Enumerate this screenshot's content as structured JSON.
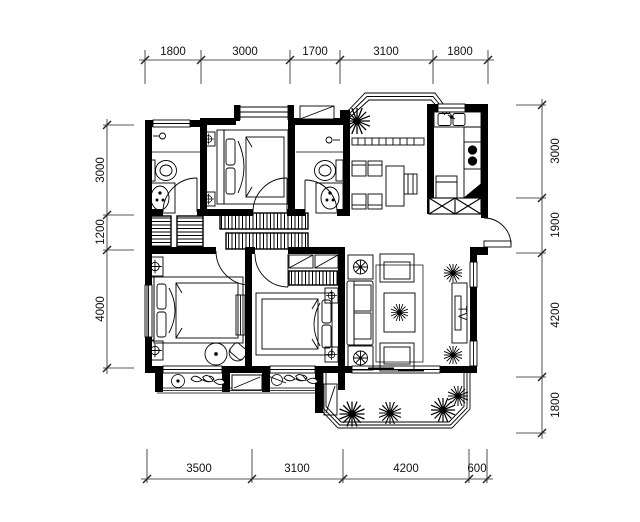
{
  "drawing": {
    "type": "residential-floor-plan",
    "background_color": "#ffffff",
    "line_color": "#000000",
    "tv_label": "TV"
  },
  "dimensions": {
    "top": [
      "1800",
      "3000",
      "1700",
      "3100",
      "1800"
    ],
    "left": [
      "3000",
      "1200",
      "4000"
    ],
    "right": [
      "3000",
      "1900",
      "4200",
      "1800"
    ],
    "bottom": [
      "3500",
      "3100",
      "4200",
      "600"
    ]
  },
  "fixtures": [
    "bed",
    "nightstand",
    "wardrobe",
    "closet",
    "toilet",
    "wash-basin",
    "shower",
    "dining-table",
    "dining-chair",
    "kitchen-sink",
    "stove",
    "refrigerator",
    "sofa",
    "armchair",
    "coffee-table",
    "floor-lamp",
    "tv-cabinet",
    "plant",
    "round-table",
    "desk",
    "water-heater",
    "kettle",
    "bay-window",
    "balcony",
    "entry-door"
  ]
}
